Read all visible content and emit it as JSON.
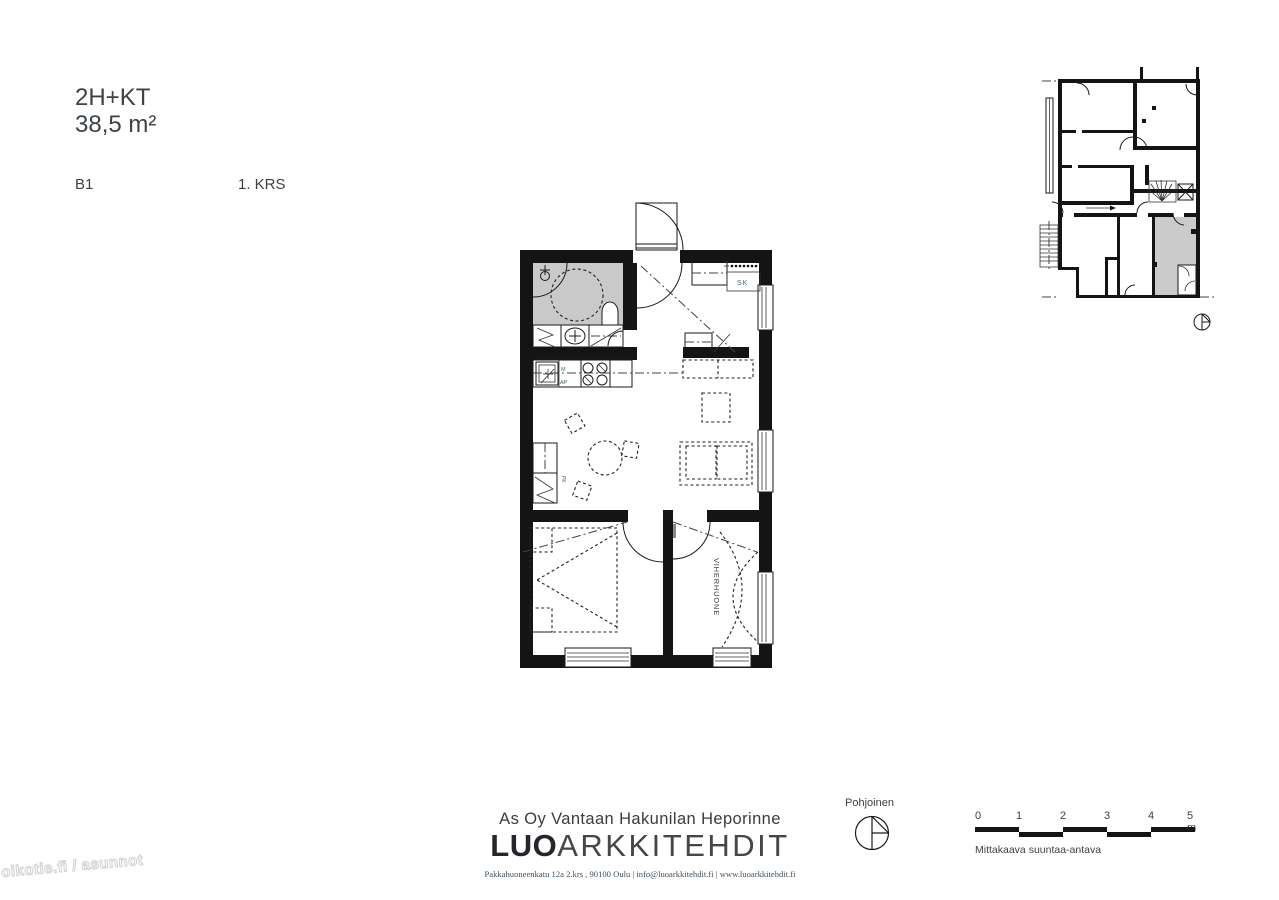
{
  "header": {
    "type": "2H+KT",
    "area": "38,5 m²",
    "unit": "B1",
    "floor": "1. KRS"
  },
  "plan_labels": {
    "closet": "SK",
    "microwave": "M",
    "dishwasher": "AP",
    "greenroom": "VIHERHUONE",
    "laundry": "PK"
  },
  "compass": {
    "label": "Pohjoinen"
  },
  "scalebar": {
    "ticks": [
      "0",
      "1",
      "2",
      "3",
      "4",
      "5 m"
    ],
    "note": "Mittakaava suuntaa-antava"
  },
  "footer": {
    "project": "As Oy Vantaan Hakunilan Heporinne",
    "logo_bold": "LUO",
    "logo_light": "ARKKITEHDIT",
    "contact": "Pakkahuoneenkatu 12a 2.krs , 90100 Oulu | info@luoarkkitehdit.fi | www.luoarkkitehdit.fi"
  },
  "watermark": "oikotie.fi / asunnot",
  "colors": {
    "wall": "#141414",
    "bathroom_fill": "#c9c9c9",
    "highlight_unit_fill": "#cbcbcb",
    "label_accent": "#4a6865",
    "text": "#3c4245"
  }
}
